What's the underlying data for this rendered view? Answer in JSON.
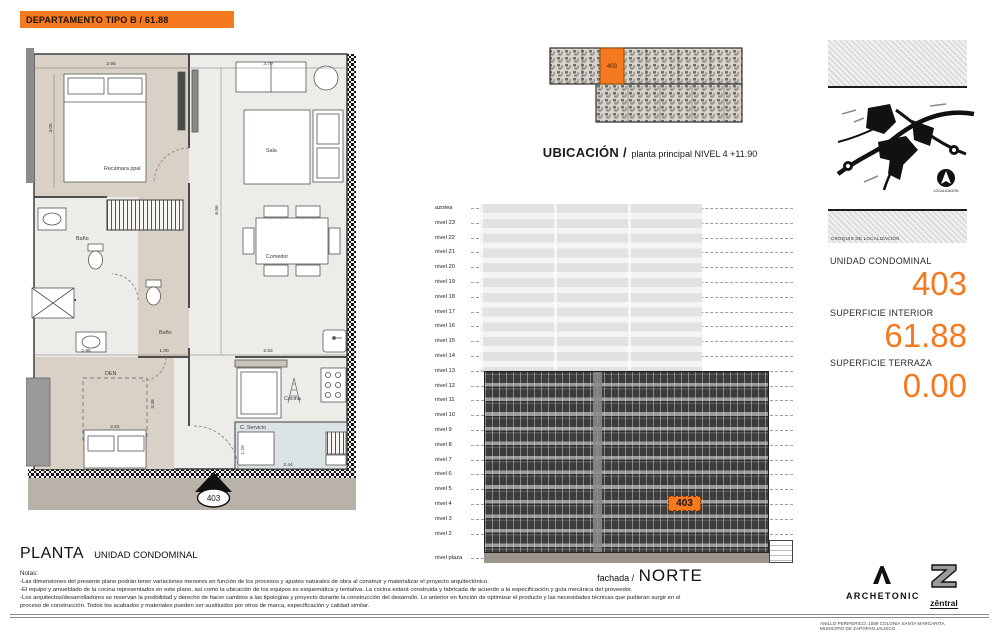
{
  "colors": {
    "accent": "#F5791F"
  },
  "header": {
    "title": "DEPARTAMENTO TIPO B / 61.88"
  },
  "plan": {
    "rooms": {
      "recamara": "Recámara ppal",
      "bano_1": "Baño",
      "bano_2": "Baño",
      "sala": "Sala",
      "comedor": "Comedor",
      "den": "DEN",
      "cocina": "Cocina",
      "servicio": "C. Servicio"
    },
    "entry_unit": "403",
    "dims": {
      "top": "2.95",
      "sala_top": "3.70",
      "left": "3.05",
      "mid_1": "2.96",
      "mid_2": "1.00",
      "mid_3": "2.53",
      "tall": "6.56",
      "den_h": "3.38",
      "den_w": "2.61",
      "serv_w": "2.44",
      "serv_h": "1.20"
    }
  },
  "ubicacion": {
    "unit": "403",
    "title": "UBICACIÓN /",
    "subtitle": "planta principal NIVEL 4 +11.90"
  },
  "elevation": {
    "levels": [
      "azotea",
      "nivel 23",
      "nivel 22",
      "nivel 21",
      "nivel 20",
      "nivel 19",
      "nivel 18",
      "nivel 17",
      "nivel 16",
      "nivel 15",
      "nivel 14",
      "nivel 13",
      "nivel 12",
      "nivel 11",
      "nivel 10",
      "nivel 9",
      "nivel 8",
      "nivel 7",
      "nivel 6",
      "nivel 5",
      "nivel 4",
      "nivel 3",
      "nivel 2",
      "nivel plaza"
    ],
    "unit_marker": "403",
    "caption_prefix": "fachada /",
    "caption": "NORTE"
  },
  "panel": {
    "croquis": "CROQUIS DE LOCALIZACIÓN",
    "localizacion": "LOCALIZACIÓN",
    "unidad_label": "UNIDAD CONDOMINAL",
    "unidad_value": "403",
    "interior_label": "SUPERFICIE INTERIOR",
    "interior_value": "61.88",
    "terraza_label": "SUPERFICIE TERRAZA",
    "terraza_value": "0.00"
  },
  "footer": {
    "planta": "PLANTA",
    "planta_sub": "UNIDAD CONDOMINAL",
    "notas_title": "Notas:",
    "notes": [
      "-Las dimensiones del presente plano podrán tener variaciones menores en función de los procesos y ajustes naturales de obra al construir y materializar el proyecto arquitectónico.",
      "-El equipo y amueblado de la cocina representados en este plano, así como la ubicación de los equipos es esquemática y tentativa. La cocina estará construida y fabricada de acuerdo a la especificación y guía mecánica del proveedor.",
      "-Los arquitectos/desarrolladores se reservan la posibilidad y derecho de hacer cambios a las tipologías y proyecto durante la construcción del desarrollo. Lo anterior en función de optimizar el producto y las necesidades técnicas que pudieran surgir en el",
      "proceso de construcción. Todos los acabados y materiales pueden ser sustituidos por otros de marca, especificación y calidad similar."
    ],
    "archetonic": "ARCHETONIC",
    "zentral": "zēntral",
    "address_1": "ANILLO PERIFÉRICO, 1089 COLONIA SANTA MARGARITA,",
    "address_2": "MUNICIPIO DE ZAPOPAN JALISCO."
  }
}
